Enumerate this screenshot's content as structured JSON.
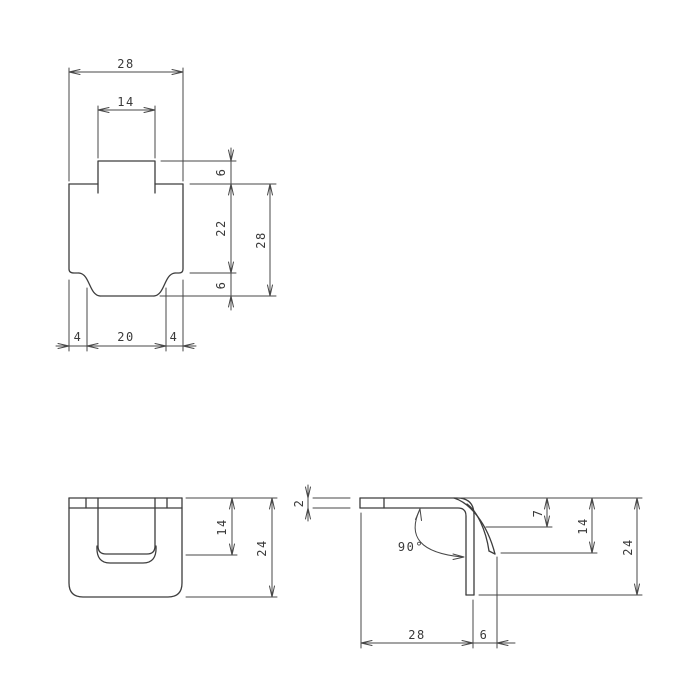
{
  "drawing": {
    "type": "technical-drawing-three-views",
    "colors": {
      "line": "#3d3d3d",
      "dimension_line": "#474747",
      "text": "#3a3a3a",
      "background": "#ffffff"
    },
    "flat_pattern": {
      "top_width": "28",
      "tab_width": "14",
      "tab_height": "6",
      "upper_height": "22",
      "overall_height": "28",
      "lower_height": "6",
      "bottom_left_inset": "4",
      "bottom_width": "20",
      "bottom_right_inset": "4"
    },
    "front_view": {
      "tab_depth": "14",
      "height": "24"
    },
    "side_view": {
      "thickness": "2",
      "bend_angle": "90°",
      "tab_drop": "7",
      "tab_tip_depth": "14",
      "height": "24",
      "leg_length": "28",
      "tab_protrusion": "6"
    }
  }
}
